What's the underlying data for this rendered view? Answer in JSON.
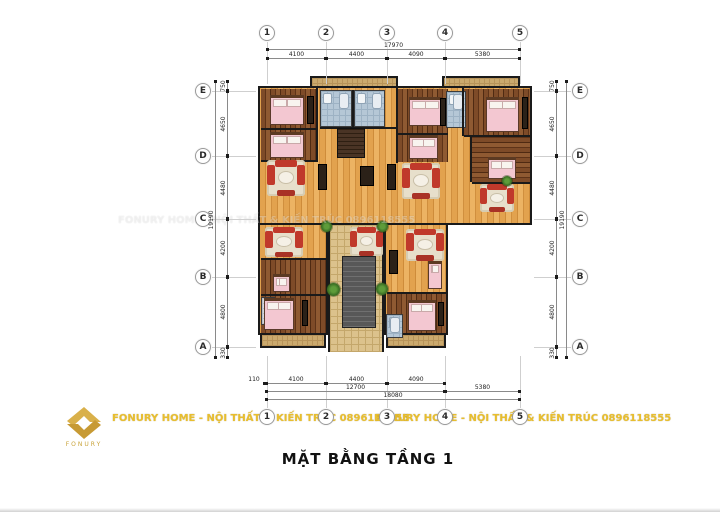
{
  "title": "MẶT BẰNG  TẦNG 1",
  "watermark": {
    "text": "FONURY HOME - NỘI THẤT & KIẾN TRÚC 0896118555"
  },
  "logo": {
    "brand": "FONURY"
  },
  "grid": {
    "columns": [
      "1",
      "2",
      "3",
      "4",
      "5"
    ],
    "rows": [
      "E",
      "D",
      "C",
      "B",
      "A"
    ]
  },
  "dimensions": {
    "top": {
      "total": "17970",
      "segments": [
        "4100",
        "4400",
        "4090",
        "5380"
      ]
    },
    "left": {
      "total": "19190",
      "segments": [
        "750",
        "4650",
        "4480",
        "4200",
        "4800",
        "330"
      ]
    },
    "right": {
      "total": "19190",
      "segments": [
        "750",
        "4650",
        "4480",
        "4200",
        "4800",
        "330"
      ]
    },
    "bottom": {
      "row1": [
        "110",
        "4100",
        "4400",
        "4090"
      ],
      "row2": [
        "12700",
        "5380"
      ],
      "total": "18080"
    }
  },
  "palette": {
    "wall": "#1a1a1a",
    "wood_light": "#e0a04c",
    "wood_dark": "#7c4a27",
    "bed_pink": "#f3c7d1",
    "tile_blue": "#b5c7d6",
    "tile_beige": "#dcc28c",
    "sofa_red": "#c0392b",
    "plant_green": "#3e7326",
    "brand_gold": "#d9b04a",
    "watermark_yellow": "#e8be2e"
  }
}
